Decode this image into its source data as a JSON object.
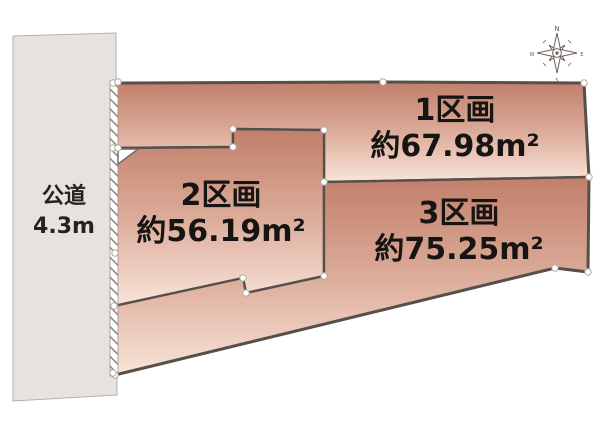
{
  "diagram_title": "土地区画図",
  "road": {
    "name": "公道",
    "width_label": "4.3m"
  },
  "plots": [
    {
      "name": "1区画",
      "area": "約67.98m²"
    },
    {
      "name": "2区画",
      "area": "約56.19m²"
    },
    {
      "name": "3区画",
      "area": "約75.25m²"
    }
  ],
  "compass": {
    "n": "N",
    "e": "E",
    "s": "S",
    "w": "W"
  },
  "colors": {
    "plot_gradient_top": "#c17f6a",
    "plot_gradient_mid": "#dcab99",
    "plot_gradient_bottom": "#f9e4da",
    "road_fill": "#e7e2dd",
    "road_border": "#b7b0a9",
    "boundary_line": "#56504a",
    "compass_color": "#6b5f58",
    "background": "#ffffff"
  }
}
